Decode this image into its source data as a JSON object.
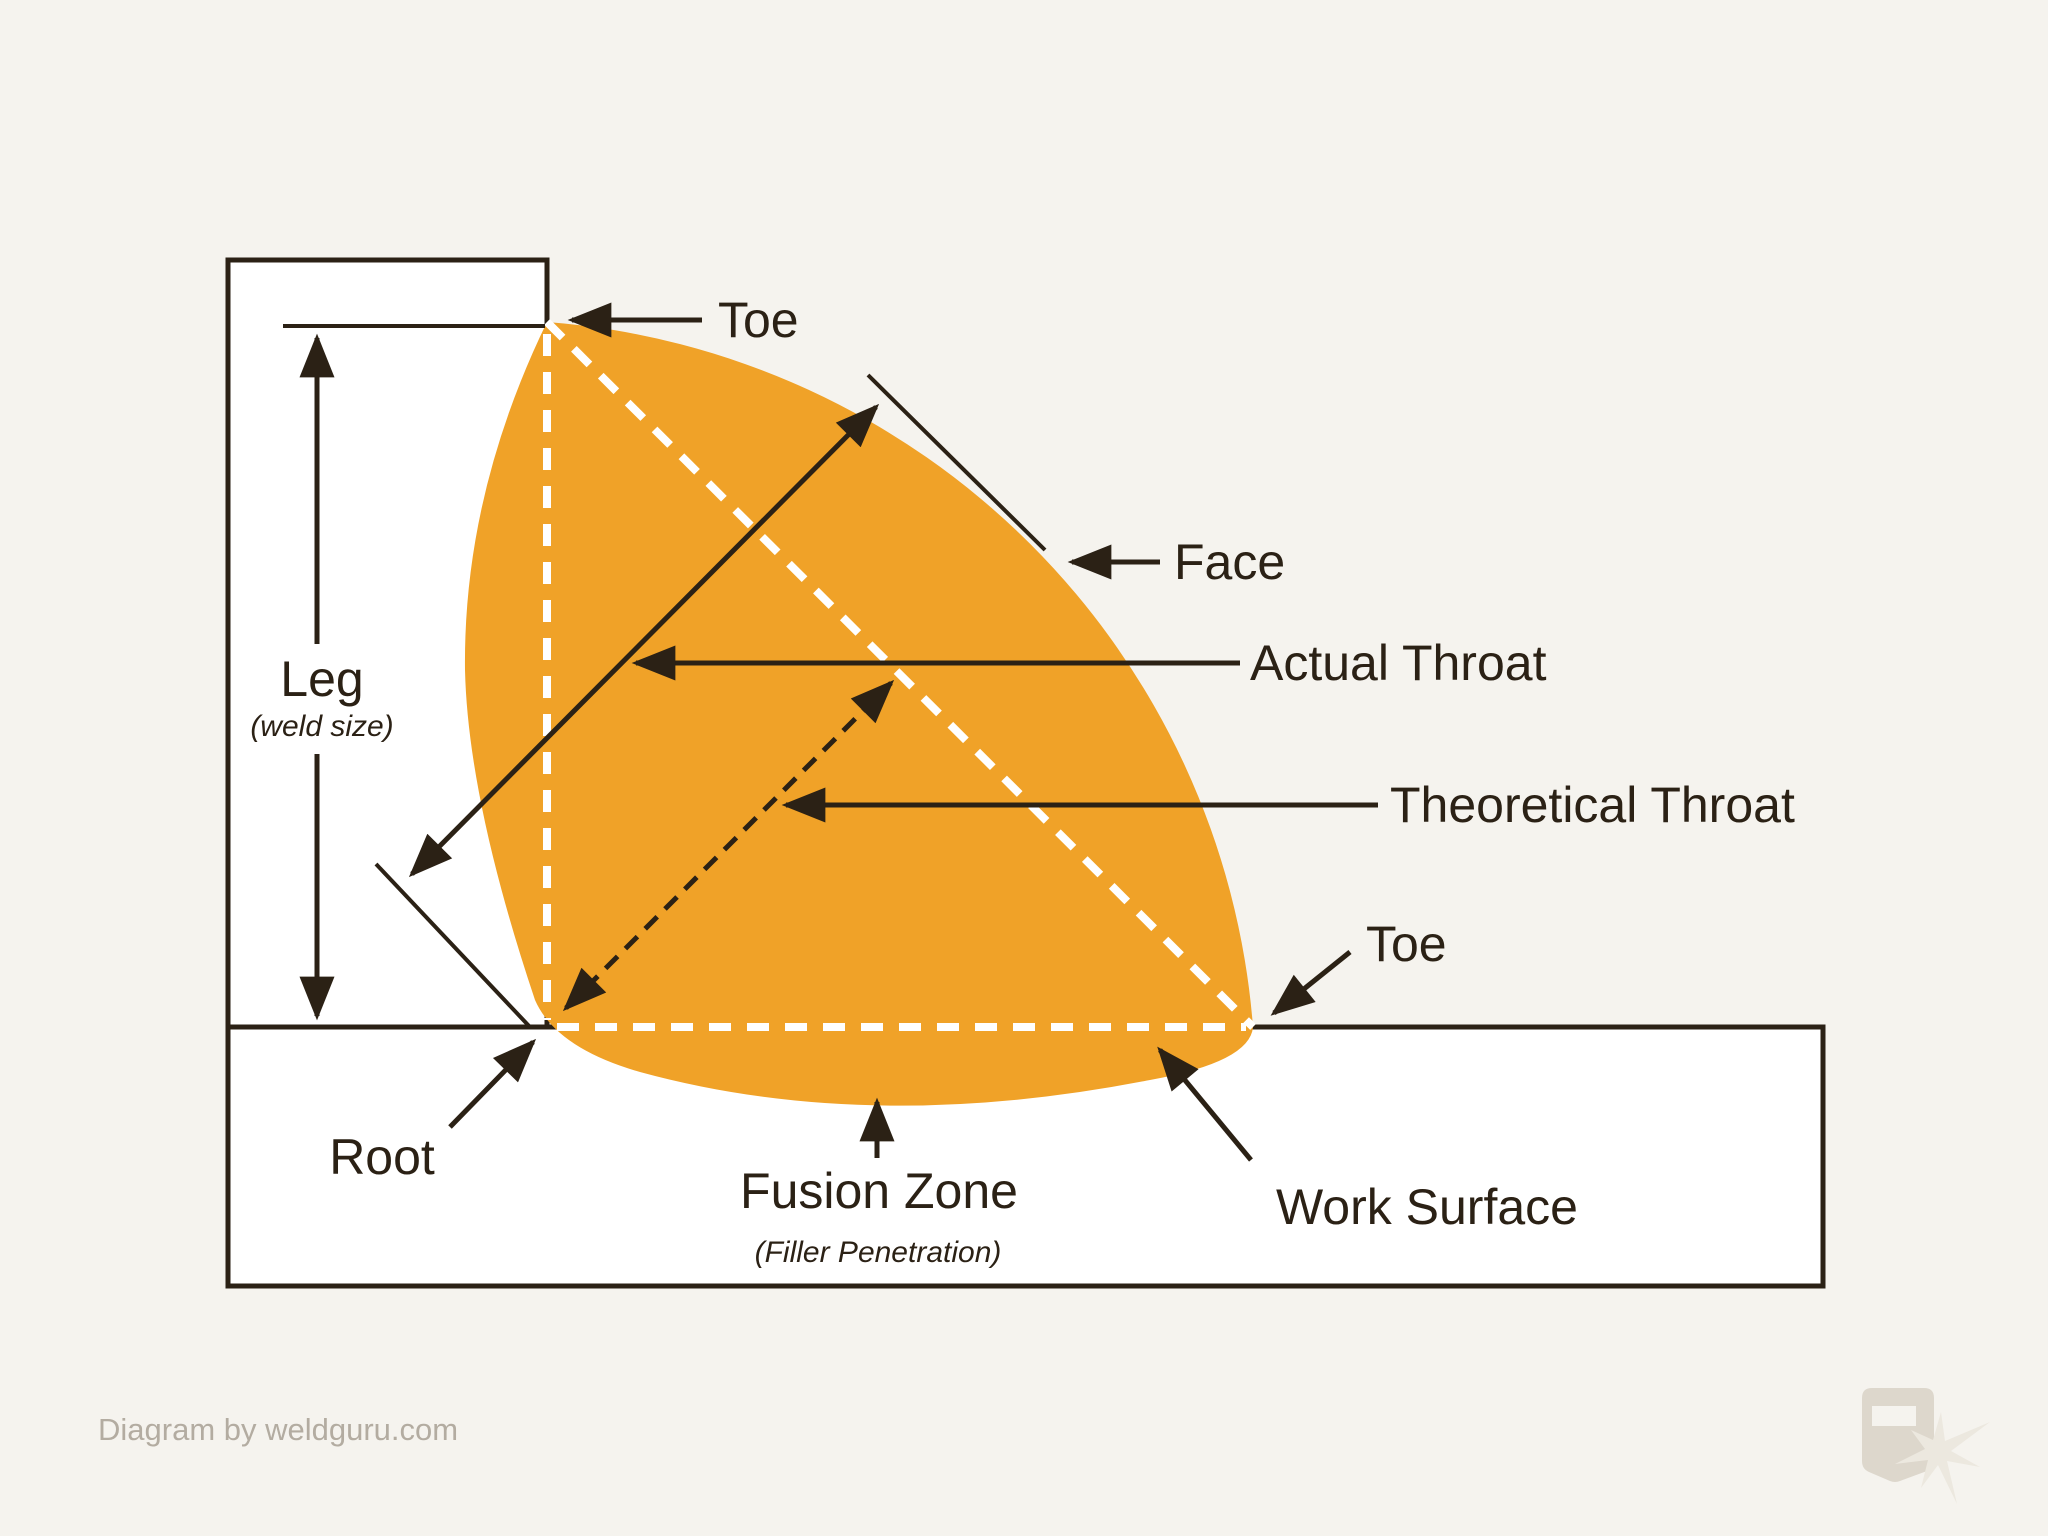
{
  "labels": {
    "toe_top": "Toe",
    "face": "Face",
    "actual_throat": "Actual Throat",
    "theoretical_throat": "Theoretical Throat",
    "toe_right": "Toe",
    "leg": "Leg",
    "leg_sub": "(weld size)",
    "root": "Root",
    "fusion_zone": "Fusion Zone",
    "fusion_zone_sub": "(Filler Penetration)",
    "work_surface": "Work Surface"
  },
  "footer": {
    "credit": "Diagram by weldguru.com"
  },
  "icons": {
    "logo": "welding-helmet-spark-logo"
  },
  "colors": {
    "background": "#F5F3EE",
    "plate_fill": "#FFFFFF",
    "line": "#2B2115",
    "weld_orange": "#F0A228",
    "dashed_overlay": "#FFFFFF",
    "footer_text": "#B3ACA1",
    "logo_gray": "#DDD7CC"
  }
}
